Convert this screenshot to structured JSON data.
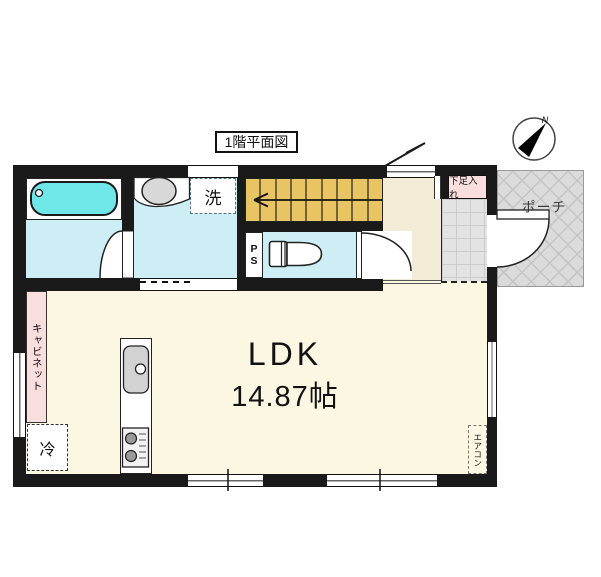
{
  "title": "1階平面図",
  "compass": {
    "north_label": "N"
  },
  "rooms": {
    "ldk": {
      "label": "LDK",
      "area": "14.87帖"
    },
    "washer_space": {
      "label": "洗"
    },
    "shoe_storage": {
      "label": "下足入れ"
    },
    "porch": {
      "label": "ポーチ"
    },
    "pipe_space": {
      "letters": [
        "P",
        "S"
      ]
    },
    "cabinet": {
      "label": "キャビネット"
    },
    "refrigerator": {
      "label": "冷"
    },
    "air_conditioner": {
      "label": "エアコン"
    }
  },
  "colors": {
    "wall": "#1a1a1a",
    "wet_room_floor": "#cdeef4",
    "bathtub_fill": "#6fe7e9",
    "stairs_fill": "#e9c463",
    "hall_floor": "#f2ebd5",
    "ldk_floor": "#fbf7e3",
    "accent_pink": "#f9dede",
    "porch_gray": "#dcdcdc"
  }
}
